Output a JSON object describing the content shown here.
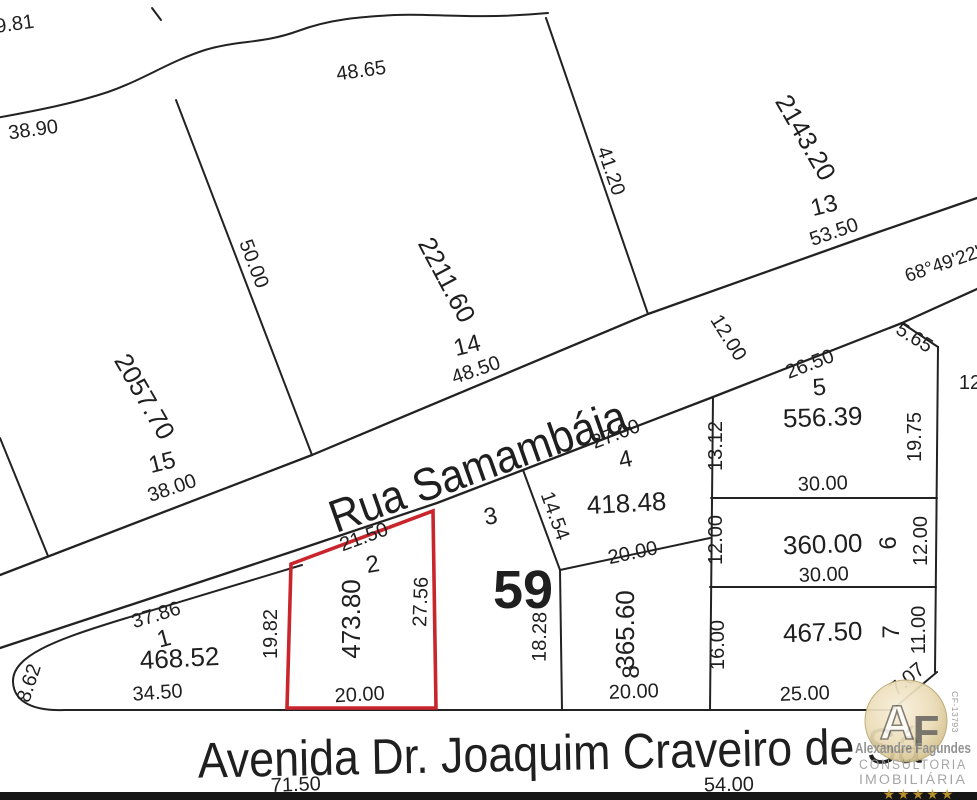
{
  "streets": {
    "rua": "Rua Samambáia",
    "avenida": "Avenida Dr. Joaquim Craveiro de Sá",
    "road_width": "12.00",
    "road_bearing": "68°49'22\"",
    "avenida_dim_left": "71.50",
    "avenida_dim_right": "54.00"
  },
  "block": {
    "number": "59"
  },
  "boundary": {
    "top_left_dim_upper": "19.81",
    "top_left_dim_lower": "38.90",
    "top_dim": "48.65",
    "right_edge_partial_dim": "12"
  },
  "lots": {
    "l15": {
      "number": "15",
      "area": "2057.70",
      "front": "38.00",
      "side": "50.00"
    },
    "l14": {
      "number": "14",
      "area": "2211.60",
      "front": "48.50",
      "side": "41.20"
    },
    "l13": {
      "number": "13",
      "area": "2143.20",
      "front": "53.50"
    },
    "l1": {
      "number": "1",
      "area": "468.52",
      "top": "37.86",
      "bottom": "34.50",
      "corner": "8.62",
      "side": "19.82"
    },
    "l2": {
      "number": "2",
      "area": "473.80",
      "front": "21.50",
      "right": "27.56",
      "bottom": "20.00"
    },
    "l3": {
      "number": "3",
      "side": "14.54"
    },
    "l4": {
      "number": "4",
      "area": "418.48",
      "front": "27.00",
      "bottom": "20.00"
    },
    "l5": {
      "number": "5",
      "area": "556.39",
      "front": "26.50",
      "chamfer": "5.65",
      "left": "13.12",
      "right": "19.75",
      "bottom": "30.00"
    },
    "l6": {
      "number": "6",
      "area": "360.00",
      "left": "12.00",
      "right": "12.00",
      "bottom": "30.00"
    },
    "l7": {
      "number": "7",
      "area": "467.50",
      "left": "16.00",
      "right": "11.00",
      "bottom": "25.00",
      "chamfer": "7.07"
    },
    "l8": {
      "number": "8",
      "area": "365.60",
      "left": "18.28",
      "bottom": "20.00"
    }
  },
  "highlight": {
    "lot": "2",
    "color": "#c9252c"
  },
  "watermark": {
    "initials_a": "A",
    "initials_f": "F",
    "name": "Alexandre Fagundes",
    "line1": "CONSULTORIA",
    "line2": "IMOBILIÁRIA",
    "stars": "★★★★★",
    "registry": "CF-13793"
  }
}
